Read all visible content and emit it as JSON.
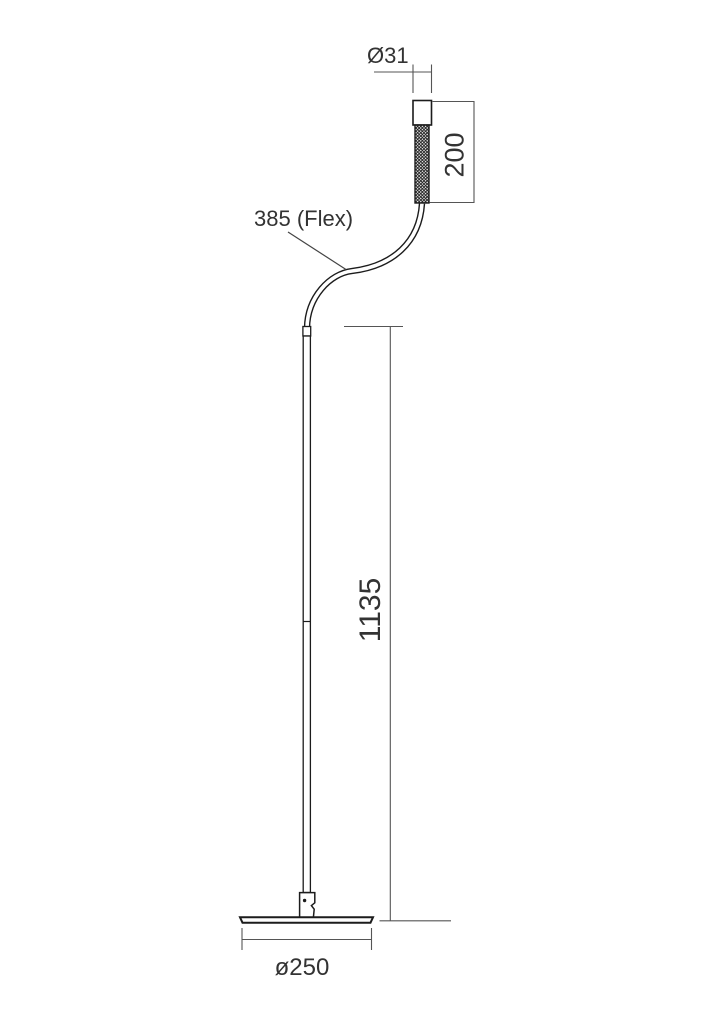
{
  "drawing": {
    "name": "flexible-led-floor-lamp-technical-drawing",
    "view": "side elevation with dimensions",
    "background": "#ffffff",
    "line_colors": {
      "object_outline": "#1c1c1c",
      "dimension_line": "#555555",
      "text": "#333333"
    },
    "dimensions": {
      "head_diameter": "Ø31",
      "head_length": "200",
      "flex_arm": "385 (Flex)",
      "pole_height": "1135",
      "base_diameter": "ø250"
    }
  }
}
